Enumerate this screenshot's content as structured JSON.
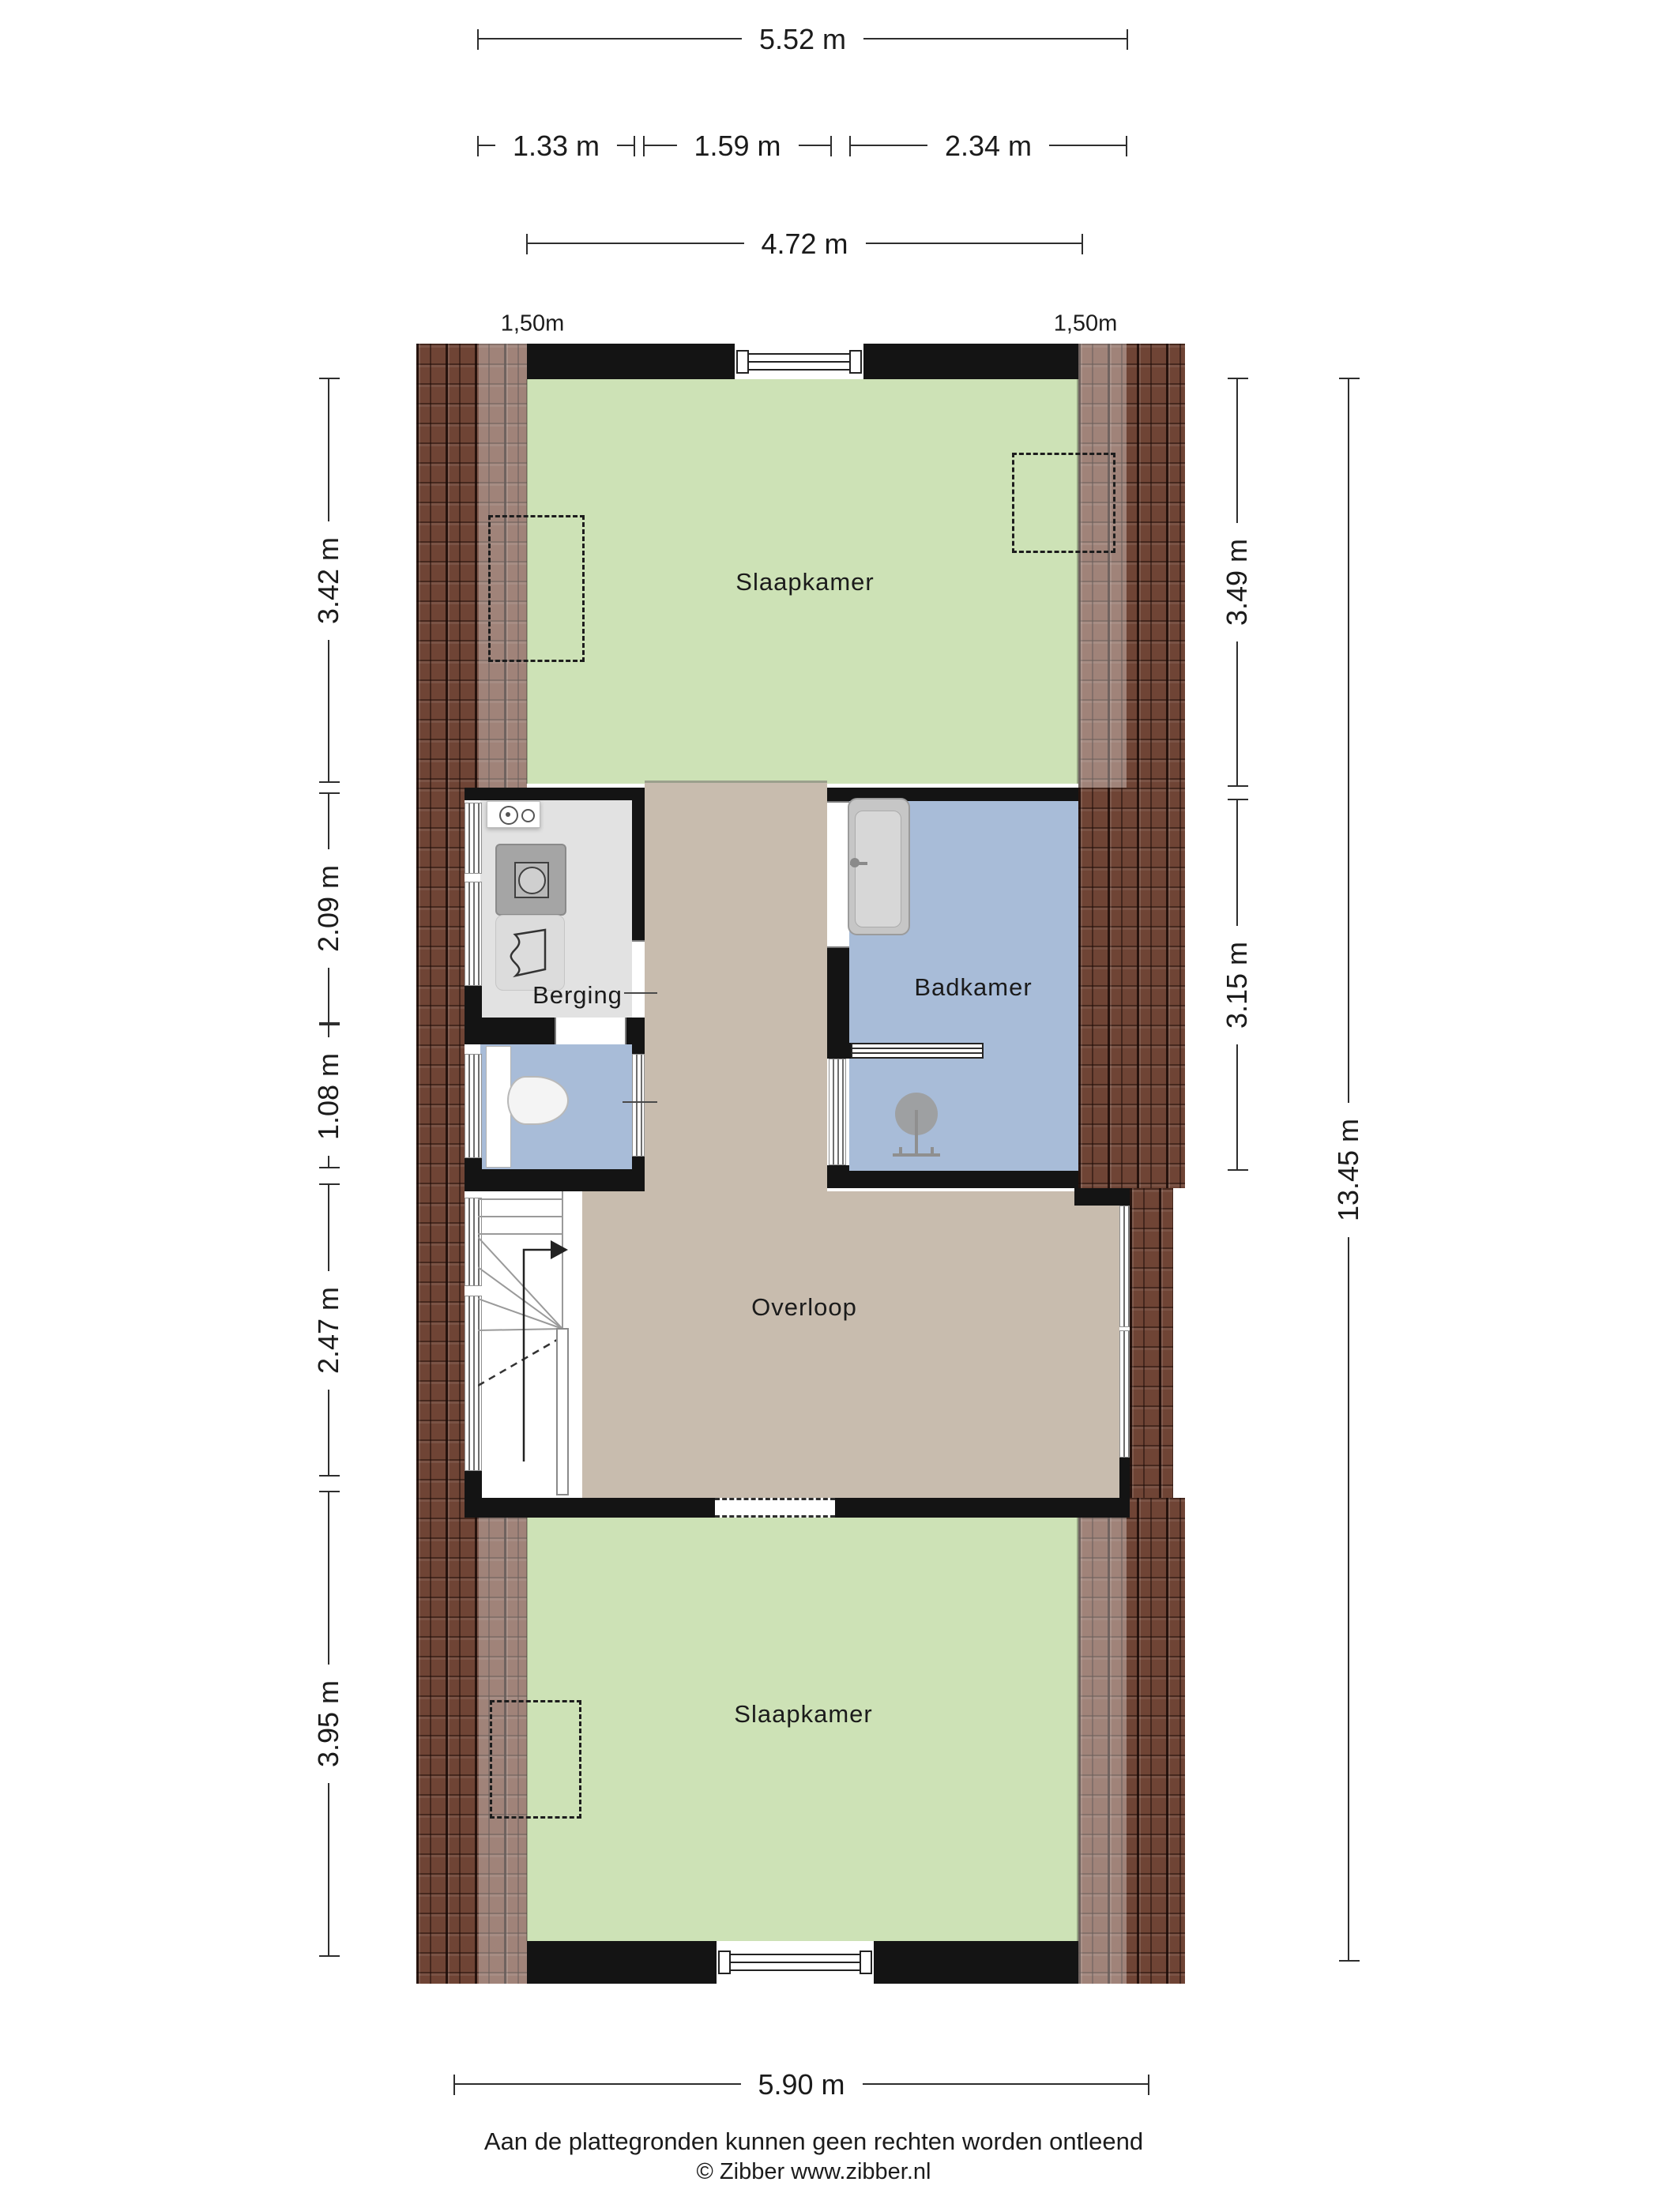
{
  "rooms": {
    "bedroom_top": "Slaapkamer",
    "storage": "Berging",
    "bathroom": "Badkamer",
    "landing": "Overloop",
    "bedroom_bottom": "Slaapkamer"
  },
  "dimensions": {
    "top_total": "5.52 m",
    "top_segments": [
      "1.33 m",
      "1.59 m",
      "2.34 m"
    ],
    "top_inner": "4.72 m",
    "headroom_left": "1,50m",
    "headroom_right": "1,50m",
    "left_segments": [
      "3.42 m",
      "2.09 m",
      "1.08 m",
      "2.47 m",
      "3.95 m"
    ],
    "right_segments": [
      "3.49 m",
      "3.15 m"
    ],
    "right_total": "13.45 m",
    "bottom_total": "5.90 m"
  },
  "footer": {
    "disclaimer": "Aan de plattegronden kunnen geen rechten worden ontleend",
    "copyright": "© Zibber www.zibber.nl"
  },
  "colors": {
    "bedroom_green": "#cde2b6",
    "bathroom_blue": "#a8bcd8",
    "landing_tan": "#c8bcae",
    "storage_gray": "#e2e2e2",
    "wall_black": "#141414",
    "roof_brick": "#6f4435",
    "dim_line": "#2e2e2e"
  }
}
